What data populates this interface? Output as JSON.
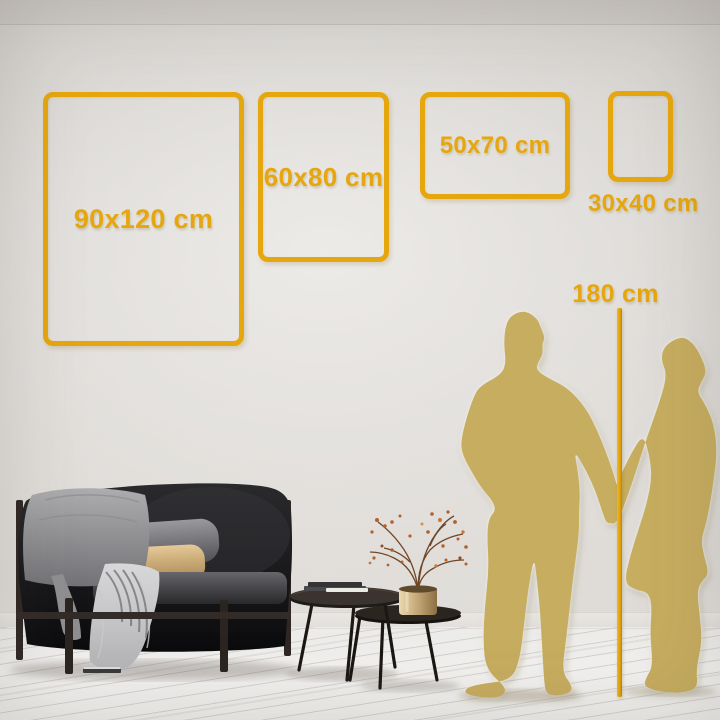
{
  "size_guide": {
    "frames": [
      {
        "name": "frame-90x120",
        "label": "90x120 cm"
      },
      {
        "name": "frame-60x80",
        "label": "60x80 cm"
      },
      {
        "name": "frame-50x70",
        "label": "50x70 cm"
      },
      {
        "name": "frame-30x40",
        "label": "30x40 cm"
      }
    ],
    "height_reference": {
      "label": "180 cm"
    }
  },
  "colors": {
    "gold": "#E6A60E",
    "silhouette_gold": "#C7AD5F",
    "wall_gray": "#D8D5D1",
    "floor_white": "#F1F0EE",
    "sofa_black": "#161618"
  },
  "scene_items": [
    "wall-size-guide",
    "couple-silhouette",
    "height-ruler",
    "sofa-with-cushions-and-throw",
    "nesting-coffee-tables",
    "books-stack",
    "brass-vase-with-dried-branches"
  ]
}
